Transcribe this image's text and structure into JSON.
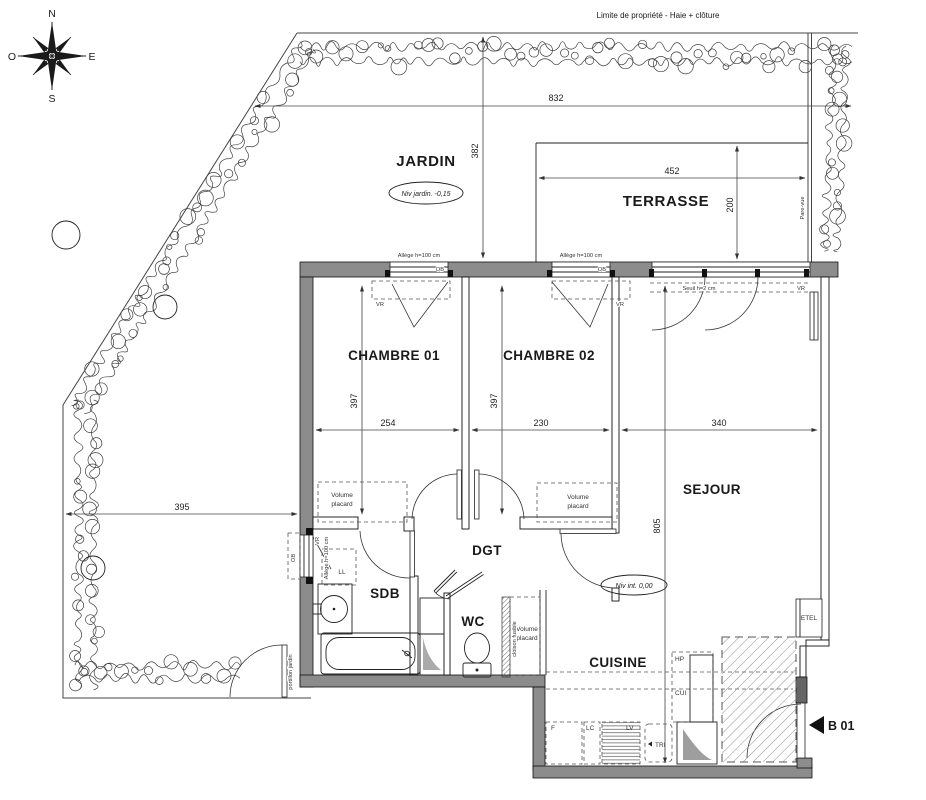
{
  "note": {
    "limite": "Limite de propriété - Haie + clôture"
  },
  "compass": {
    "n": "N",
    "s": "S",
    "e": "E",
    "o": "O"
  },
  "rooms": {
    "jardin": "JARDIN",
    "terrasse": "TERRASSE",
    "chambre1": "CHAMBRE 01",
    "chambre2": "CHAMBRE 02",
    "sejour": "SEJOUR",
    "dgt": "DGT",
    "sdb": "SDB",
    "wc": "WC",
    "cuisine": "CUISINE"
  },
  "levels": {
    "jardin": "Niv jardin. -0,15",
    "interior": "Niv int. 0,00"
  },
  "dims": {
    "d832": "832",
    "d382": "382",
    "d452": "452",
    "d200": "200",
    "d395": "395",
    "d397a": "397",
    "d397b": "397",
    "d254": "254",
    "d230": "230",
    "d340": "340",
    "d805": "805"
  },
  "win": {
    "allege": "Allège h=100 cm",
    "ob": "OB",
    "vr": "VR",
    "seuil": "Seuil h=2 cm",
    "pare_vue": "Pare-vue"
  },
  "storage": {
    "volume": "Volume",
    "placard": "placard",
    "ll": "LL",
    "cloison": "cloison fusible"
  },
  "kitchen": {
    "f": "F",
    "lc": "LC",
    "lv": "LV",
    "tri": "TRI",
    "hp": "HP",
    "cui": "CUI"
  },
  "misc": {
    "etel": "ETEL",
    "b01": "B 01",
    "portillon": "portillon jardin"
  }
}
